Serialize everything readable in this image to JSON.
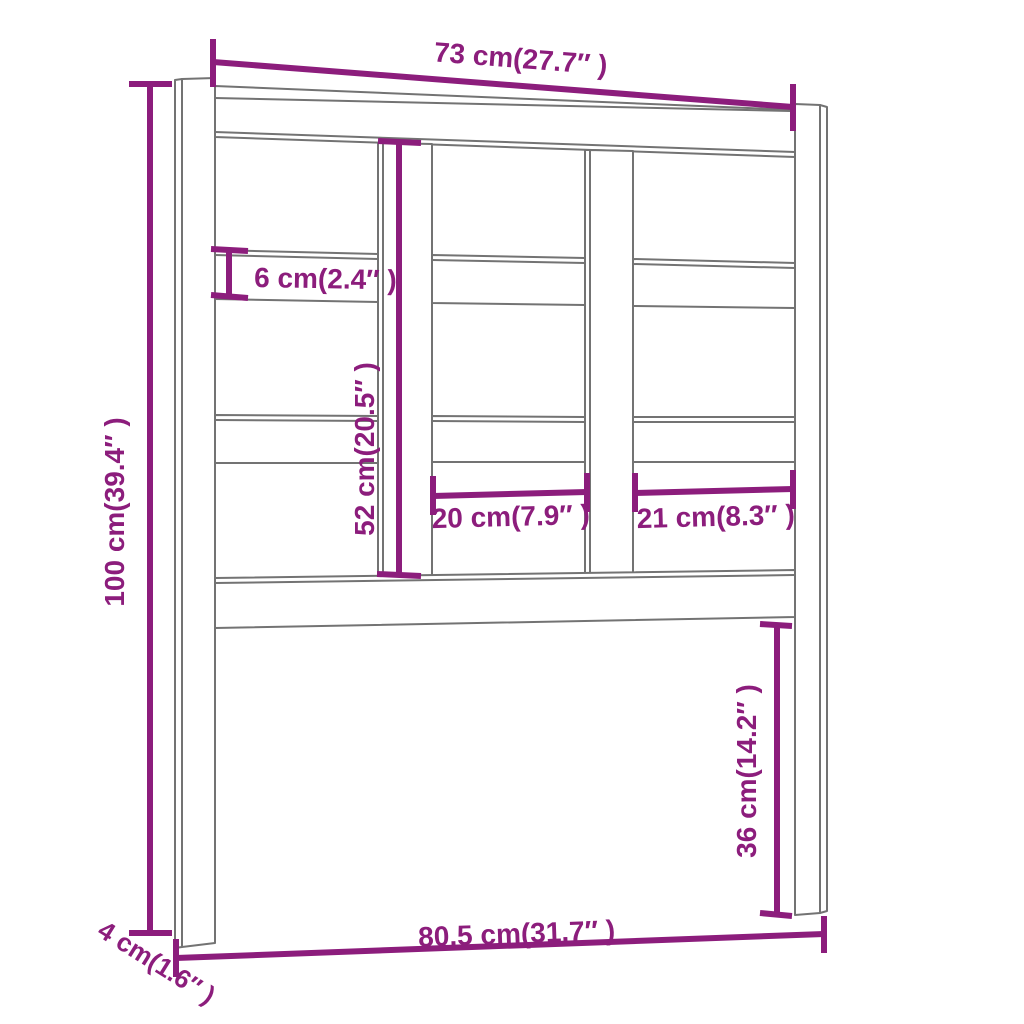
{
  "diagram": {
    "colors": {
      "dimension_color": "#8c1d7c",
      "outline_color": "#737373",
      "background": "#ffffff"
    },
    "dims": {
      "top_width": "73 cm(27.7″ )",
      "total_height": "100 cm(39.4″ )",
      "rail_height": "6 cm(2.4″ )",
      "panel_height": "52 cm(20.5″ )",
      "gap_left": "20 cm(7.9″ )",
      "gap_right": "21 cm(8.3″ )",
      "leg_height": "36 cm(14.2″ )",
      "bottom_width": "80,5 cm(31.7″ )",
      "post_depth": "4 cm(1.6″ )"
    }
  }
}
